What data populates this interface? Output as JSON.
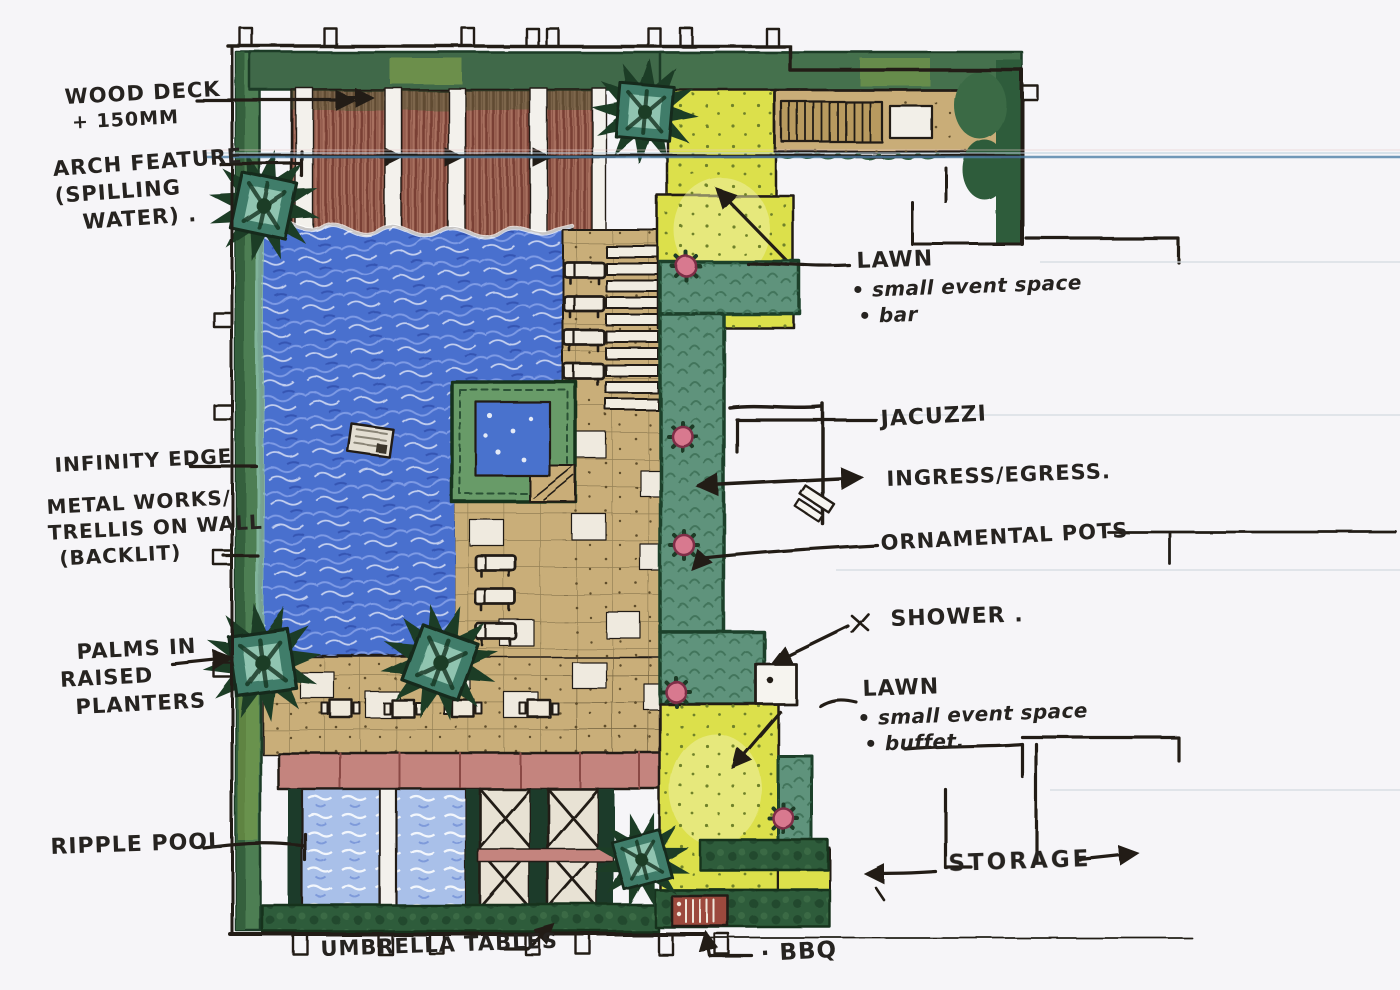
{
  "palette": {
    "paper": "#f6f5f8",
    "ink": "#241f19",
    "pool_blue": "#4a6fce",
    "ripple_blue": "#a9c0e9",
    "deck_brown": "#a86f5e",
    "paving_tan": "#c9ae79",
    "lawn_yellow": "#dce04c",
    "hedge_green": "#5f937c",
    "dark_green": "#2f5c3b",
    "pot_pink": "#d8798f",
    "scan_line_blue": "#4f7fa6"
  },
  "annotations": {
    "wood_deck": {
      "line1": "WOOD DECK",
      "line2": "+ 150MM"
    },
    "arch_feature": {
      "line1": "ARCH FEATURE",
      "line2": "(SPILLING",
      "line3": "WATER) ."
    },
    "infinity_edge": {
      "line1": "INFINITY EDGE"
    },
    "metal_works": {
      "line1": "METAL WORKS/",
      "line2": "TRELLIS ON WALL",
      "line3": "(BACKLIT)"
    },
    "palms": {
      "line1": "PALMS IN",
      "line2": "RAISED",
      "line3": "PLANTERS"
    },
    "ripple_pool": {
      "line1": "RIPPLE POOL"
    },
    "umbrella_tables": {
      "line1": "UMBRELLA TABLES"
    },
    "bbq": {
      "line1": "· BBQ"
    },
    "lawn_top": {
      "line1": "LAWN",
      "line2": "• small event space",
      "line3": "• bar"
    },
    "jacuzzi": {
      "line1": "JACUZZI"
    },
    "ingress_egress": {
      "line1": "INGRESS/EGRESS."
    },
    "ornamental_pots": {
      "line1": "ORNAMENTAL POTS"
    },
    "shower": {
      "line1": "SHOWER ."
    },
    "lawn_bottom": {
      "line1": "LAWN",
      "line2": "• small event space",
      "line3": "• buffet."
    },
    "storage": {
      "line1": "STORAGE"
    }
  }
}
